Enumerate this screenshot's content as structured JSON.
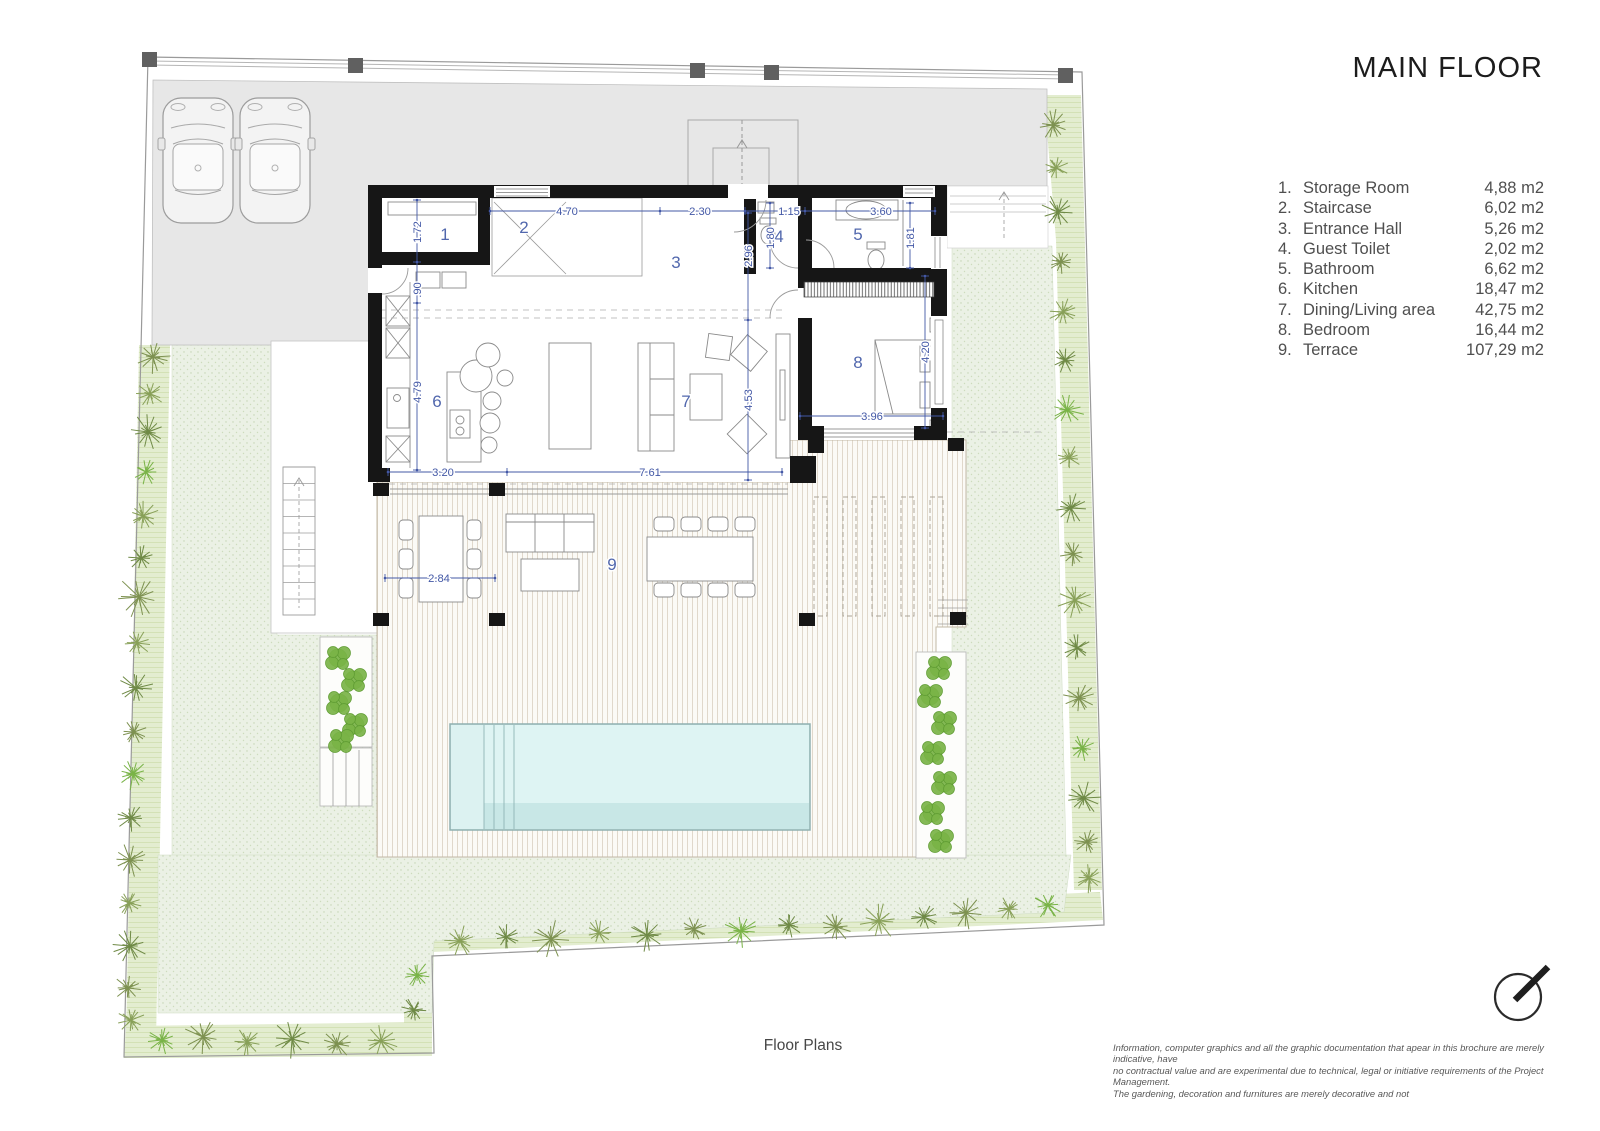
{
  "title": "MAIN FLOOR",
  "legend": [
    {
      "num": "1.",
      "label": "Storage Room",
      "area": "4,88 m2"
    },
    {
      "num": "2.",
      "label": "Staircase",
      "area": "6,02 m2"
    },
    {
      "num": "3.",
      "label": "Entrance Hall",
      "area": "5,26 m2"
    },
    {
      "num": "4.",
      "label": "Guest Toilet",
      "area": "2,02 m2"
    },
    {
      "num": "5.",
      "label": "Bathroom",
      "area": "6,62 m2"
    },
    {
      "num": "6.",
      "label": "Kitchen",
      "area": "18,47 m2"
    },
    {
      "num": "7.",
      "label": "Dining/Living area",
      "area": "42,75 m2"
    },
    {
      "num": "8.",
      "label": "Bedroom",
      "area": "16,44 m2"
    },
    {
      "num": "9.",
      "label": "Terrace",
      "area": "107,29 m2"
    }
  ],
  "caption": "Floor Plans",
  "disclaimer": [
    "Information, computer graphics and all the graphic documentation that apear in this brochure are merely indicative, have",
    "no contractual value and are experimental due to technical, legal or initiative requirements of the Project Management.",
    "The gardening, decoration and furnitures are merely decorative and not"
  ],
  "plan": {
    "room_labels": [
      {
        "id": "1",
        "x": 445,
        "y": 240
      },
      {
        "id": "2",
        "x": 524,
        "y": 233
      },
      {
        "id": "3",
        "x": 676,
        "y": 268
      },
      {
        "id": "4",
        "x": 779,
        "y": 242
      },
      {
        "id": "5",
        "x": 858,
        "y": 240
      },
      {
        "id": "6",
        "x": 437,
        "y": 407
      },
      {
        "id": "7",
        "x": 686,
        "y": 407
      },
      {
        "id": "8",
        "x": 858,
        "y": 368
      },
      {
        "id": "9",
        "x": 612,
        "y": 570
      }
    ],
    "dimensions": [
      {
        "text": "4.70",
        "x": 567,
        "y": 215,
        "rot": 0
      },
      {
        "text": "2.30",
        "x": 700,
        "y": 215,
        "rot": 0
      },
      {
        "text": "1.15",
        "x": 789,
        "y": 215,
        "rot": 0
      },
      {
        "text": "3.60",
        "x": 881,
        "y": 215,
        "rot": 0
      },
      {
        "text": "1.72",
        "x": 421,
        "y": 232,
        "rot": -90
      },
      {
        "text": ".90",
        "x": 421,
        "y": 290,
        "rot": -90
      },
      {
        "text": "4.79",
        "x": 421,
        "y": 392,
        "rot": -90
      },
      {
        "text": "2.96",
        "x": 752,
        "y": 256,
        "rot": -90
      },
      {
        "text": "4.53",
        "x": 752,
        "y": 400,
        "rot": -90
      },
      {
        "text": "1.80",
        "x": 774,
        "y": 238,
        "rot": -90
      },
      {
        "text": "1.81",
        "x": 914,
        "y": 238,
        "rot": -90
      },
      {
        "text": "4.20",
        "x": 929,
        "y": 352,
        "rot": -90
      },
      {
        "text": "3.96",
        "x": 872,
        "y": 420,
        "rot": 0
      },
      {
        "text": "3.20",
        "x": 443,
        "y": 476,
        "rot": 0
      },
      {
        "text": "7.61",
        "x": 650,
        "y": 476,
        "rot": 0
      },
      {
        "text": "2.84",
        "x": 439,
        "y": 582,
        "rot": 0
      }
    ]
  },
  "colors": {
    "dimension_blue": "#4358a6",
    "wall_black": "#161616",
    "grass": "#ebf1e5",
    "garden_band": "#e3edd0",
    "driveway_gray": "#e7e7e7",
    "pool_water": "#d2edec",
    "plant_olive": "#7d9150",
    "plant_bright": "#79b347"
  }
}
